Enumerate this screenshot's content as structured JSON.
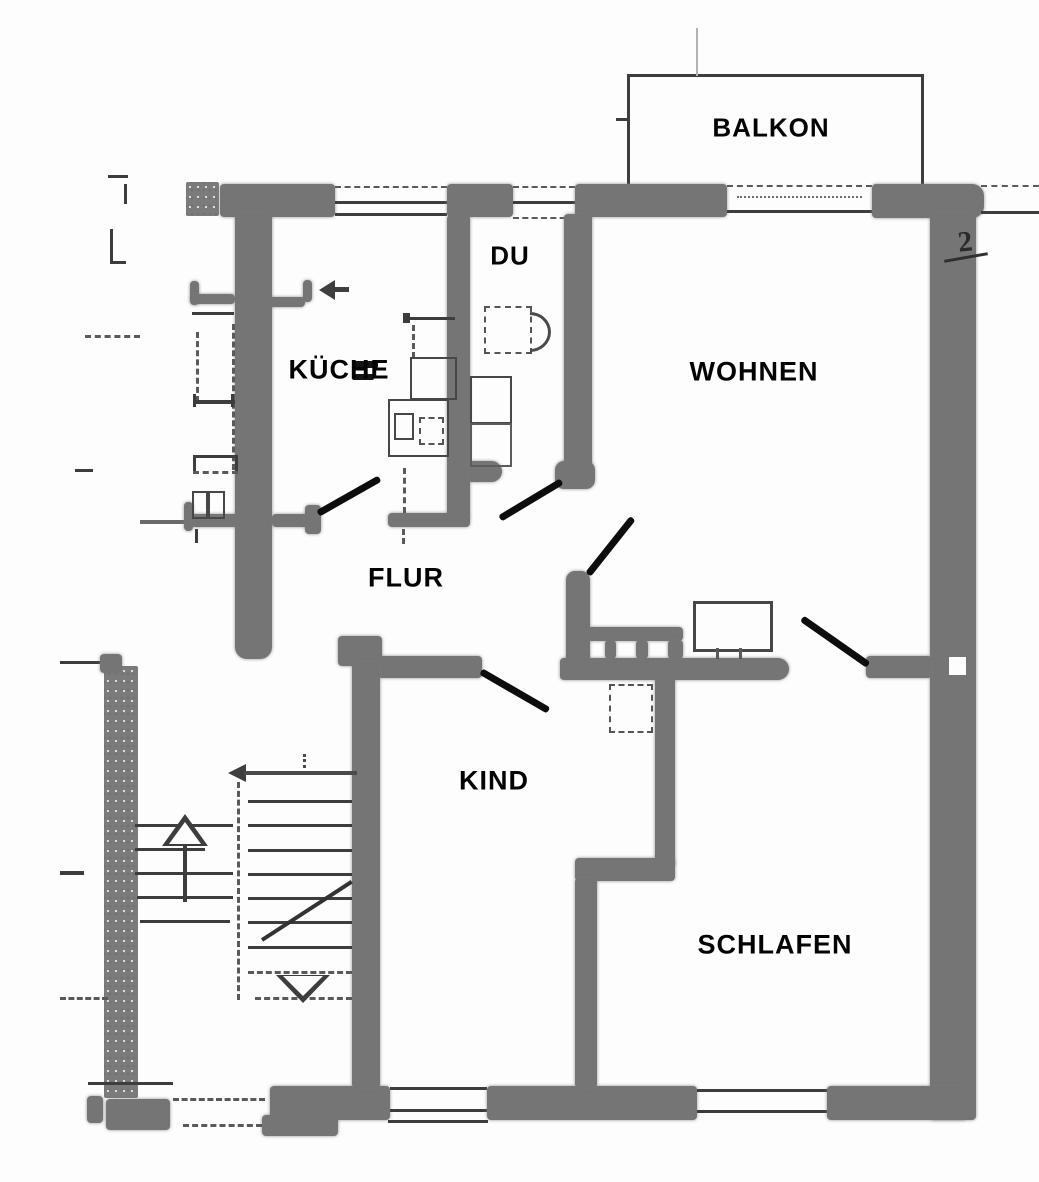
{
  "plan": {
    "type": "apartment-floor-plan",
    "rooms": [
      {
        "id": "balkon",
        "label": "BALKON"
      },
      {
        "id": "du",
        "label": "DU"
      },
      {
        "id": "kueche",
        "label": "KÜCHE"
      },
      {
        "id": "wohnen",
        "label": "WOHNEN"
      },
      {
        "id": "flur",
        "label": "FLUR"
      },
      {
        "id": "kind",
        "label": "KIND"
      },
      {
        "id": "schlafen",
        "label": "SCHLAFEN"
      }
    ],
    "annotations": [
      {
        "id": "floor-number",
        "text": "2"
      }
    ],
    "doors": [
      {
        "id": "kueche-door"
      },
      {
        "id": "du-door"
      },
      {
        "id": "wohnen-door"
      },
      {
        "id": "schlafen-door"
      },
      {
        "id": "kind-door"
      }
    ],
    "icons": [
      "entrance-arrow-icon",
      "stairs-up-arrow-icon",
      "stairs-down-arrow-icon"
    ],
    "colors": {
      "wall_gray": "#757575",
      "line_dark": "#3d3d3d",
      "ink_black": "#0d0d0d",
      "background": "#fdfdfd"
    }
  }
}
